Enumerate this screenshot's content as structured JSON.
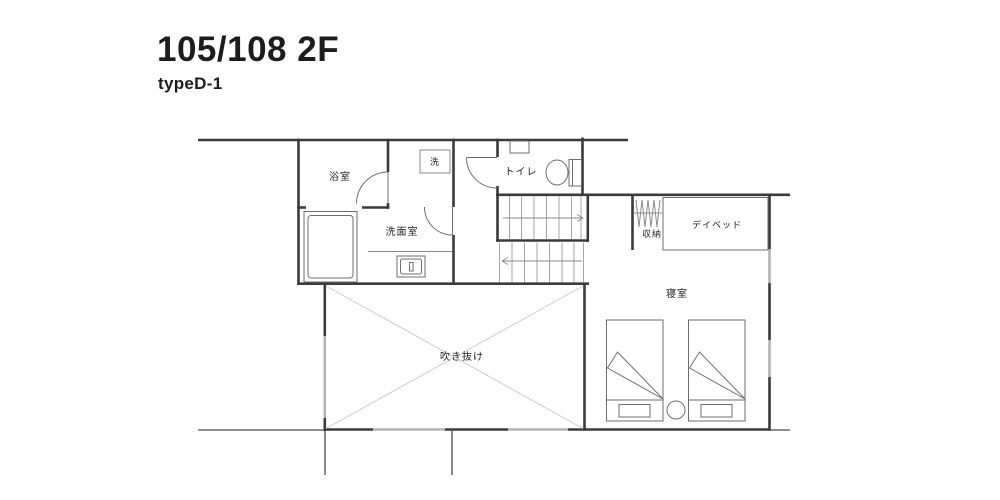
{
  "header": {
    "title": "105/108 2F",
    "subtitle": "typeD-1"
  },
  "floorplan": {
    "rooms": {
      "bathroom": "浴室",
      "washer": "洗",
      "toilet": "トイレ",
      "washroom": "洗面室",
      "storage": "収納",
      "daybed": "デイベッド",
      "bedroom": "寝室",
      "void": "吹き抜け"
    },
    "colors": {
      "wall": "#3b3b3b",
      "window": "#b3b3b3",
      "fixture": "#6e6e6e",
      "tread": "#a6a6a6",
      "diagonal": "#cccccc"
    }
  }
}
